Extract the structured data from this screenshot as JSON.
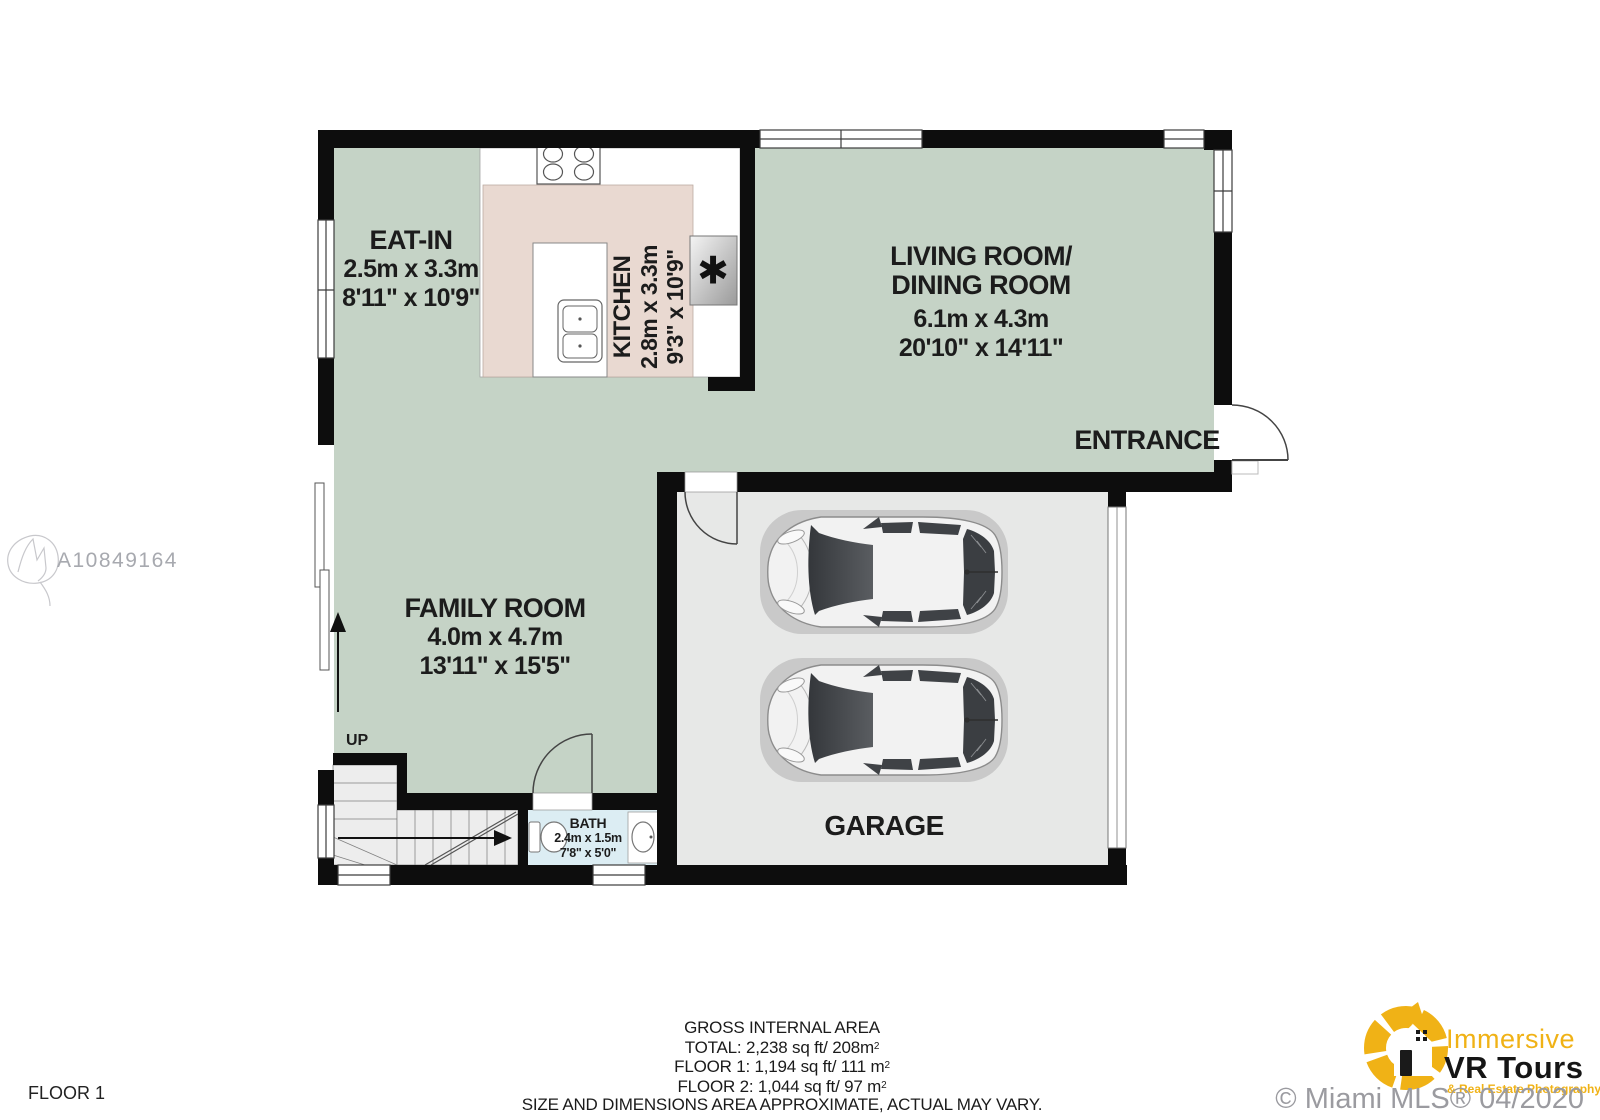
{
  "plan": {
    "rooms": {
      "eat_in": {
        "name": "EAT-IN",
        "metric": "2.5m x 3.3m",
        "imperial": "8'11\" x 10'9\""
      },
      "kitchen": {
        "name": "KITCHEN",
        "metric": "2.8m x 3.3m",
        "imperial": "9'3\" x 10'9\""
      },
      "living": {
        "name1": "LIVING ROOM/",
        "name2": "DINING ROOM",
        "metric": "6.1m x 4.3m",
        "imperial": "20'10\" x 14'11\""
      },
      "family": {
        "name": "FAMILY ROOM",
        "metric": "4.0m x 4.7m",
        "imperial": "13'11\" x 15'5\""
      },
      "garage": {
        "name": "GARAGE"
      },
      "bath": {
        "name": "BATH",
        "metric": "2.4m x 1.5m",
        "imperial": "7'8\" x 5'0\""
      }
    },
    "labels": {
      "entrance": "ENTRANCE",
      "up": "UP",
      "fridge_symbol": "✱"
    },
    "floor_tag": "FLOOR 1"
  },
  "footer": {
    "heading": "GROSS INTERNAL AREA",
    "total": {
      "text": "TOTAL: 2,238 sq ft/ 208m",
      "sup": "2"
    },
    "floor1": {
      "text": "FLOOR 1: 1,194 sq ft/ 111 m",
      "sup": "2"
    },
    "floor2": {
      "text": "FLOOR 2: 1,044 sq ft/ 97 m",
      "sup": "2"
    },
    "disclaimer": "SIZE AND DIMENSIONS AREA APPROXIMATE, ACTUAL MAY VARY."
  },
  "watermarks": {
    "mls_number": "A10849164",
    "copyright": "© Miami MLS® 04/2020"
  },
  "logo": {
    "line1": "Immersive",
    "line2": "VR Tours",
    "line3": "& Real Estate Photography"
  },
  "colors": {
    "room_green": "#c5d3c6",
    "kitchen_pink": "#e9d9d1",
    "garage_gray": "#e7e8e7",
    "bath_blue": "#dcedf3",
    "wall": "#0d0d0d",
    "logo_yellow": "#f0b216",
    "watermark_gray": "#9b9ba0"
  }
}
